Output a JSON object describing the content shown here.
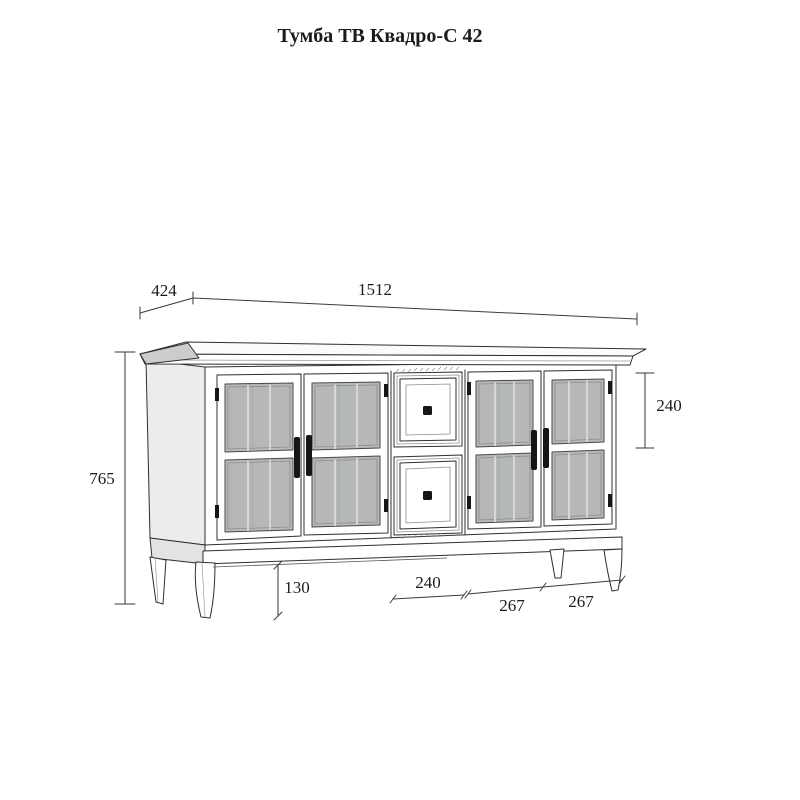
{
  "title": "Тумба ТВ Квадро-С 42",
  "dimensions": {
    "depth": "424",
    "width": "1512",
    "height": "765",
    "top_drawer_height": "240",
    "leg_height": "130",
    "drawer_width": "240",
    "door_width_a": "267",
    "door_width_b": "267"
  },
  "colors": {
    "line": "#2f2f2f",
    "glass": "#b5b8b7",
    "side_shade": "#ececec",
    "crown_shade": "#cccccc"
  }
}
